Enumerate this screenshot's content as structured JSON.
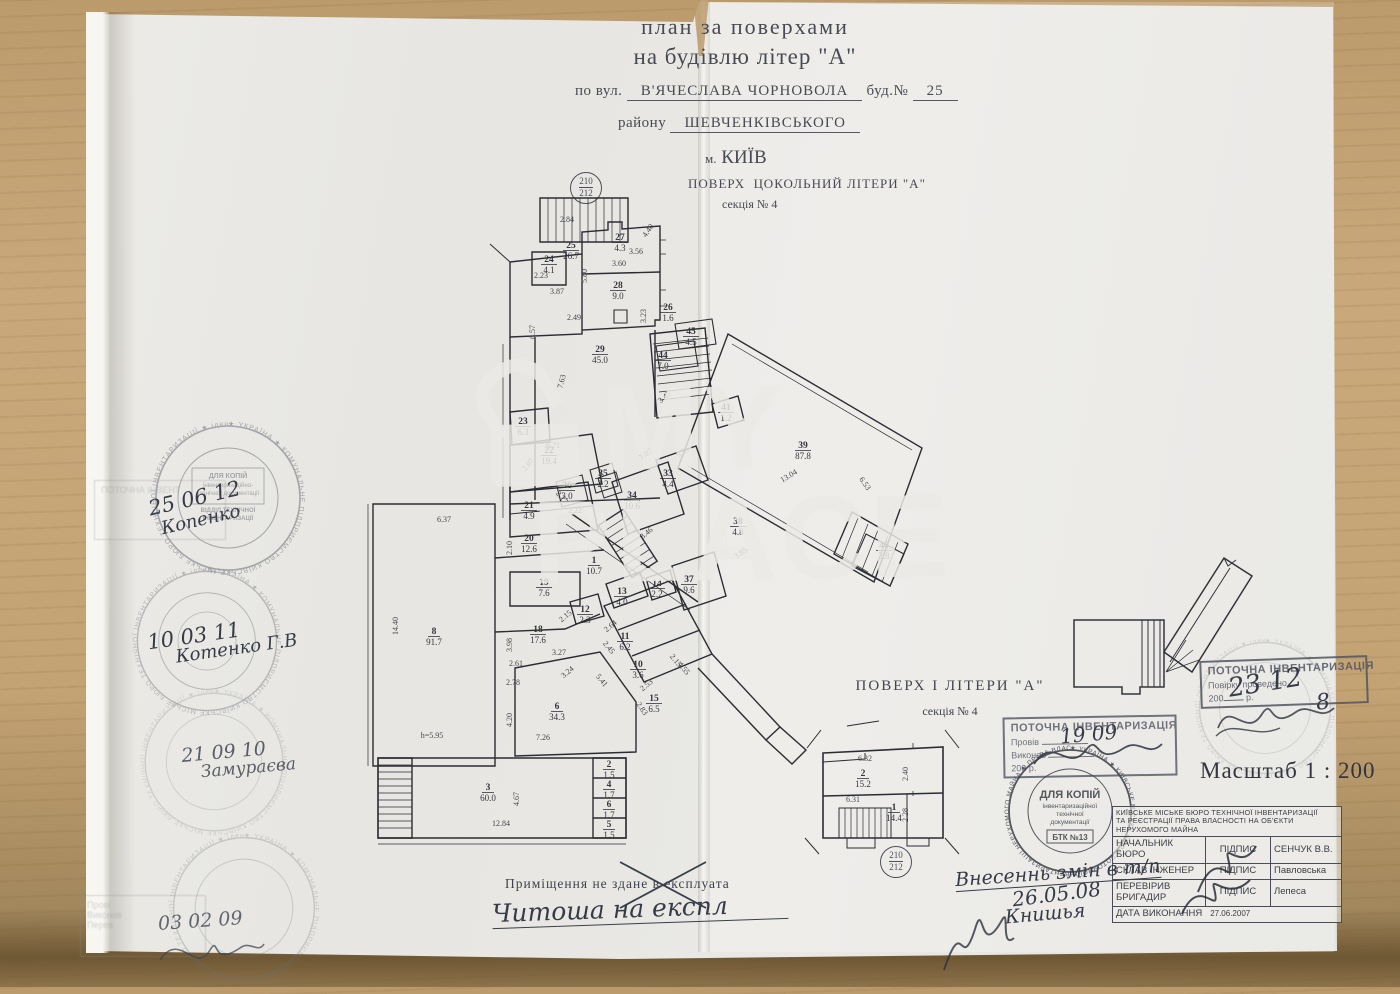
{
  "header": {
    "title_line1": "план за поверхами",
    "title_line2": "на будівлю  літер \"А\"",
    "street_label": "по вул.",
    "street_value": "В'ЯЧЕСЛАВА ЧОРНОВОЛА",
    "building_label": "буд.№",
    "building_value": "25",
    "district_label": "району",
    "district_value": "ШЕВЧЕНКІВСЬКОГО",
    "city_label": "м.",
    "city_value": "КИЇВ",
    "floor_label": "ПОВЕРХ",
    "floor_value": "ЦОКОЛЬНИЙ ЛІТЕРИ \"А\"",
    "section": "секція № 4"
  },
  "sheet_badge": {
    "top": "210",
    "bottom": "212"
  },
  "plan": {
    "rooms": [
      {
        "n": "24",
        "a": "4.1",
        "x": 189,
        "y": 80
      },
      {
        "n": "25",
        "a": "26.7",
        "x": 211,
        "y": 66
      },
      {
        "n": "27",
        "a": "4.3",
        "x": 260,
        "y": 58
      },
      {
        "n": "28",
        "a": "9.0",
        "x": 258,
        "y": 106
      },
      {
        "n": "26",
        "a": "1.6",
        "x": 308,
        "y": 128
      },
      {
        "n": "29",
        "a": "45.0",
        "x": 240,
        "y": 170
      },
      {
        "n": "45",
        "a": "4.5",
        "x": 331,
        "y": 152
      },
      {
        "n": "44",
        "a": "7.0",
        "x": 303,
        "y": 176
      },
      {
        "n": "41",
        "a": "1.2",
        "x": 366,
        "y": 228
      },
      {
        "n": "39",
        "a": "87.8",
        "x": 443,
        "y": 266
      },
      {
        "n": "46",
        "a": "2.8",
        "x": 524,
        "y": 366
      },
      {
        "n": "38",
        "a": "4.8",
        "x": 378,
        "y": 342
      },
      {
        "n": "23",
        "a": "6.3",
        "x": 163,
        "y": 242
      },
      {
        "n": "22",
        "a": "19.4",
        "x": 189,
        "y": 271
      },
      {
        "n": "36",
        "a": "3.0",
        "x": 207,
        "y": 306
      },
      {
        "n": "35",
        "a": "2.2",
        "x": 243,
        "y": 294
      },
      {
        "n": "33",
        "a": "4.4",
        "x": 308,
        "y": 294
      },
      {
        "n": "34",
        "a": "10.6",
        "x": 272,
        "y": 316
      },
      {
        "n": "21",
        "a": "4.9",
        "x": 169,
        "y": 326
      },
      {
        "n": "20",
        "a": "12.6",
        "x": 169,
        "y": 359
      },
      {
        "n": "1",
        "a": "10.7",
        "x": 234,
        "y": 381
      },
      {
        "n": "19",
        "a": "7.6",
        "x": 184,
        "y": 403
      },
      {
        "n": "13",
        "a": "4.0",
        "x": 262,
        "y": 412
      },
      {
        "n": "12",
        "a": "2.3",
        "x": 225,
        "y": 430
      },
      {
        "n": "18",
        "a": "17.6",
        "x": 178,
        "y": 450
      },
      {
        "n": "11",
        "a": "6.2",
        "x": 265,
        "y": 457
      },
      {
        "n": "14",
        "a": "2.2",
        "x": 297,
        "y": 404
      },
      {
        "n": "37",
        "a": "9.6",
        "x": 329,
        "y": 400
      },
      {
        "n": "10",
        "a": "3.6",
        "x": 278,
        "y": 485
      },
      {
        "n": "8",
        "a": "91.7",
        "x": 74,
        "y": 452
      },
      {
        "n": "15",
        "a": "6.5",
        "x": 294,
        "y": 519
      },
      {
        "n": "6",
        "a": "34.3",
        "x": 197,
        "y": 527
      },
      {
        "n": "3",
        "a": "60.0",
        "x": 128,
        "y": 608
      },
      {
        "n": "2",
        "a": "1.5",
        "x": 249,
        "y": 585
      },
      {
        "n": "4",
        "a": "1.7",
        "x": 249,
        "y": 605
      },
      {
        "n": "6",
        "a": "1.7",
        "x": 249,
        "y": 625
      },
      {
        "n": "5",
        "a": "1.5",
        "x": 249,
        "y": 645
      }
    ],
    "dims": [
      {
        "t": "2.84",
        "x": 207,
        "y": 40
      },
      {
        "t": "3.56",
        "x": 276,
        "y": 72
      },
      {
        "t": "4.40",
        "x": 290,
        "y": 50,
        "r": -55
      },
      {
        "t": "3.60",
        "x": 259,
        "y": 84
      },
      {
        "t": "5.80",
        "x": 227,
        "y": 94,
        "r": -90
      },
      {
        "t": "2.23",
        "x": 181,
        "y": 96
      },
      {
        "t": "3.87",
        "x": 197,
        "y": 112
      },
      {
        "t": "2.49",
        "x": 214,
        "y": 138
      },
      {
        "t": "6.57",
        "x": 175,
        "y": 150,
        "r": -90
      },
      {
        "t": "3.23",
        "x": 286,
        "y": 134,
        "r": -90
      },
      {
        "t": "7.63",
        "x": 204,
        "y": 200,
        "r": -75
      },
      {
        "t": "6.71",
        "x": 193,
        "y": 266
      },
      {
        "t": "2.07",
        "x": 170,
        "y": 284,
        "r": -50
      },
      {
        "t": "1.07",
        "x": 287,
        "y": 274,
        "r": -35
      },
      {
        "t": "5.26",
        "x": 324,
        "y": 272,
        "r": -35
      },
      {
        "t": "13.04",
        "x": 430,
        "y": 296,
        "r": -31
      },
      {
        "t": "6.53",
        "x": 503,
        "y": 303,
        "r": 55
      },
      {
        "t": "14.40",
        "x": 38,
        "y": 444,
        "r": -90
      },
      {
        "t": "6.37",
        "x": 84,
        "y": 340
      },
      {
        "t": "3.98",
        "x": 152,
        "y": 463,
        "r": -90
      },
      {
        "t": "2.61",
        "x": 156,
        "y": 484
      },
      {
        "t": "3.27",
        "x": 199,
        "y": 473
      },
      {
        "t": "3.24",
        "x": 209,
        "y": 492,
        "r": -40
      },
      {
        "t": "2.78",
        "x": 153,
        "y": 503
      },
      {
        "t": "4.20",
        "x": 152,
        "y": 538,
        "r": -90
      },
      {
        "t": "7.26",
        "x": 183,
        "y": 558
      },
      {
        "t": "h=5.95",
        "x": 72,
        "y": 556
      },
      {
        "t": "12.84",
        "x": 141,
        "y": 644
      },
      {
        "t": "4.67",
        "x": 159,
        "y": 617,
        "r": -90
      },
      {
        "t": "2.15",
        "x": 207,
        "y": 436,
        "r": -40
      },
      {
        "t": "2.64",
        "x": 252,
        "y": 446,
        "r": -40
      },
      {
        "t": "2.45",
        "x": 247,
        "y": 467,
        "r": 50
      },
      {
        "t": "5.41",
        "x": 240,
        "y": 500,
        "r": 50
      },
      {
        "t": "2.53",
        "x": 288,
        "y": 505,
        "r": -40
      },
      {
        "t": "2.83",
        "x": 280,
        "y": 528,
        "r": 55
      },
      {
        "t": "4.55",
        "x": 322,
        "y": 488,
        "r": 50
      },
      {
        "t": "2.15",
        "x": 314,
        "y": 480,
        "r": 50
      },
      {
        "t": "3.45",
        "x": 306,
        "y": 217,
        "r": -40
      },
      {
        "t": "3.85",
        "x": 382,
        "y": 373,
        "r": -35
      },
      {
        "t": "3.46",
        "x": 288,
        "y": 353,
        "r": -40
      },
      {
        "t": "2.17",
        "x": 200,
        "y": 317,
        "r": 50
      },
      {
        "t": "2.22",
        "x": 215,
        "y": 331
      },
      {
        "t": "2.10",
        "x": 152,
        "y": 366,
        "r": -90
      }
    ]
  },
  "watermark": {
    "word1": "MY",
    "word2": "PLACE"
  },
  "floor1_plan": {
    "title": "ПОВЕРХ   І  ЛІТЕРИ  \"А\"",
    "section": "секція № 4",
    "rooms": [
      {
        "n": "2",
        "a": "15.2",
        "x": 68,
        "y": 58
      },
      {
        "n": "1",
        "a": "14.4",
        "x": 99,
        "y": 92
      }
    ],
    "dims": [
      {
        "t": "6.32",
        "x": 70,
        "y": 43
      },
      {
        "t": "2.40",
        "x": 113,
        "y": 56,
        "r": -90
      },
      {
        "t": "6.31",
        "x": 58,
        "y": 84
      },
      {
        "t": "2.28",
        "x": 113,
        "y": 97,
        "r": -90
      }
    ]
  },
  "scale_label": "Масштаб 1 : 200",
  "notes": {
    "typed": "Приміщення не здане в експлуата",
    "handwritten": "Читоша  на  експл",
    "changes_title": "Внесеннь  змін  в  т/п",
    "changes_date": "26.05.08",
    "changes_sign": "Книшья"
  },
  "stamps": {
    "left_round": {
      "ring": "★ УКРАЇНА ★ КОМУНАЛЬНЕ ПІДПРИЄМСТВО КИЇВСЬКЕ МІСЬКЕ БЮРО ТЕХНІЧНОЇ ІНВЕНТАРИЗАЦІЇ ★ ідентифікаційний код 03359836 ★",
      "inner1": "ДЛЯ КОПІЙ",
      "inner2": "інвентаризаційно-",
      "inner3": "технічної документації",
      "inner4": "ВІДДІЛ ТЕХНІЧНОЇ",
      "inner5": "ІНВЕНТАРИЗАЦІЇ"
    },
    "dlya_kopiy": {
      "ring": "★ УКРАЇНА ★ КИЇВСЬКЕ МІСЬКЕ БЮРО ПОТОЧНОЇ ІНВЕНТАРИЗАЦІЇ НЕРУХОМОГО МАЙНА ★ ПРАВА ВЛАСНОСТІ НА ОБ'ЄКТИ ★",
      "l1": "ДЛЯ КОПІЙ",
      "l2": "інвентаризаційної",
      "l3": "технічної",
      "l4": "документації",
      "l5": "БТК №13"
    },
    "potochna_center": {
      "title": "ПОТОЧНА ІНВЕНТАРИЗАЦІЯ",
      "row1": "Провів",
      "hand": "19  09",
      "row2": "Виконав",
      "row3": "200    р."
    },
    "potochna_right": {
      "title": "ПОТОЧНА ІНВЕНТАРИЗАЦІЯ",
      "row1": "Повірку проведено",
      "hand_date": "23 12",
      "year": "200",
      "hand_year": "8",
      "year_suffix": "р."
    },
    "ghost_title": "ПОТОЧНА ІНВЕНТ",
    "ghost_rows": [
      "Прові",
      "Виконав",
      "Перев"
    ],
    "hand_notes": [
      {
        "date": "25  06  12",
        "sign": "Копенко"
      },
      {
        "date": "10   03   11",
        "sign": "Котенко Г.В"
      },
      {
        "date": "21   09   10",
        "sign": "Замураєва"
      },
      {
        "date": "03   02   09",
        "sign": ""
      }
    ]
  },
  "bti_table": {
    "header1": "КИЇВСЬКЕ МІСЬКЕ БЮРО ТЕХНІЧНОЇ ІНВЕНТАРИЗАЦІЇ",
    "header2": "ТА РЕЄСТРАЦІЇ ПРАВА ВЛАСНОСТІ НА ОБ'ЄКТИ",
    "header3": "НЕРУХОМОГО МАЙНА",
    "rows": [
      {
        "role": "НАЧАЛЬНИК БЮРО",
        "mid": "ПІДПИС",
        "name": "СЕНЧУК В.В."
      },
      {
        "role": "СКЛАВ ІНЖЕНЕР",
        "mid": "ПІДПИС",
        "name": "Павловська"
      },
      {
        "role": "ПЕРЕВІРИВ БРИГАДИР",
        "mid": "ПІДПИС",
        "name": "Лепеса"
      }
    ],
    "date_label": "ДАТА ВИКОНАННЯ",
    "date_value": "27.06.2007"
  }
}
